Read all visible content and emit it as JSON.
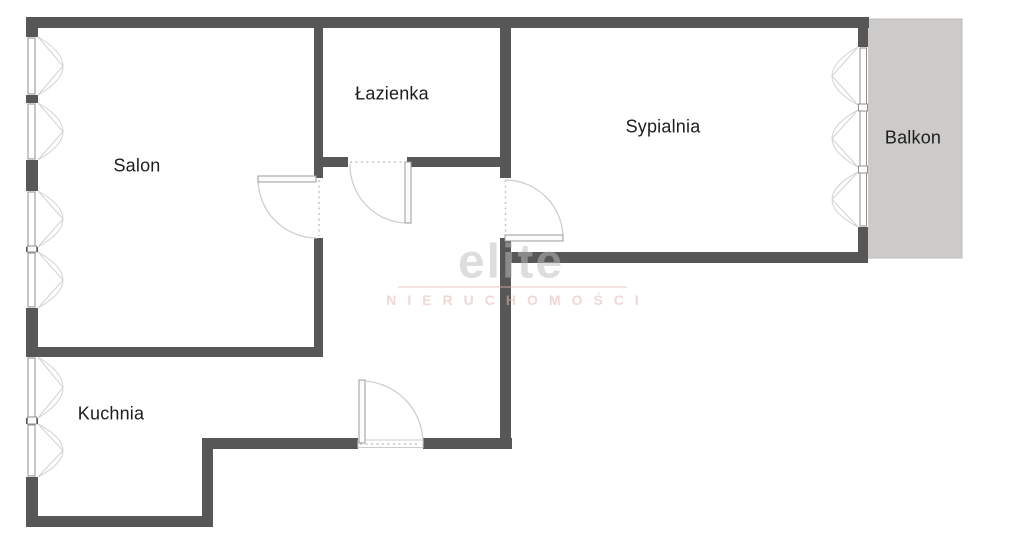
{
  "plan": {
    "rooms": [
      {
        "id": "salon",
        "label": "Salon"
      },
      {
        "id": "lazienka",
        "label": "Łazienka"
      },
      {
        "id": "sypialnia",
        "label": "Sypialnia"
      },
      {
        "id": "balkon",
        "label": "Balkon"
      },
      {
        "id": "kuchnia",
        "label": "Kuchnia"
      }
    ],
    "watermark": {
      "brand": "elite",
      "subtitle": "NIERUCHOMOŚCI"
    },
    "colors": {
      "wall": "#575757",
      "balcony_fill": "#cccbc9",
      "window_frame": "#8f8f8f",
      "swing": "#d2d2d2",
      "label_text": "#1d1d1d",
      "watermark_gray": "#bdbdbd",
      "watermark_pink": "#e7b6b6",
      "background": "#ffffff"
    }
  }
}
